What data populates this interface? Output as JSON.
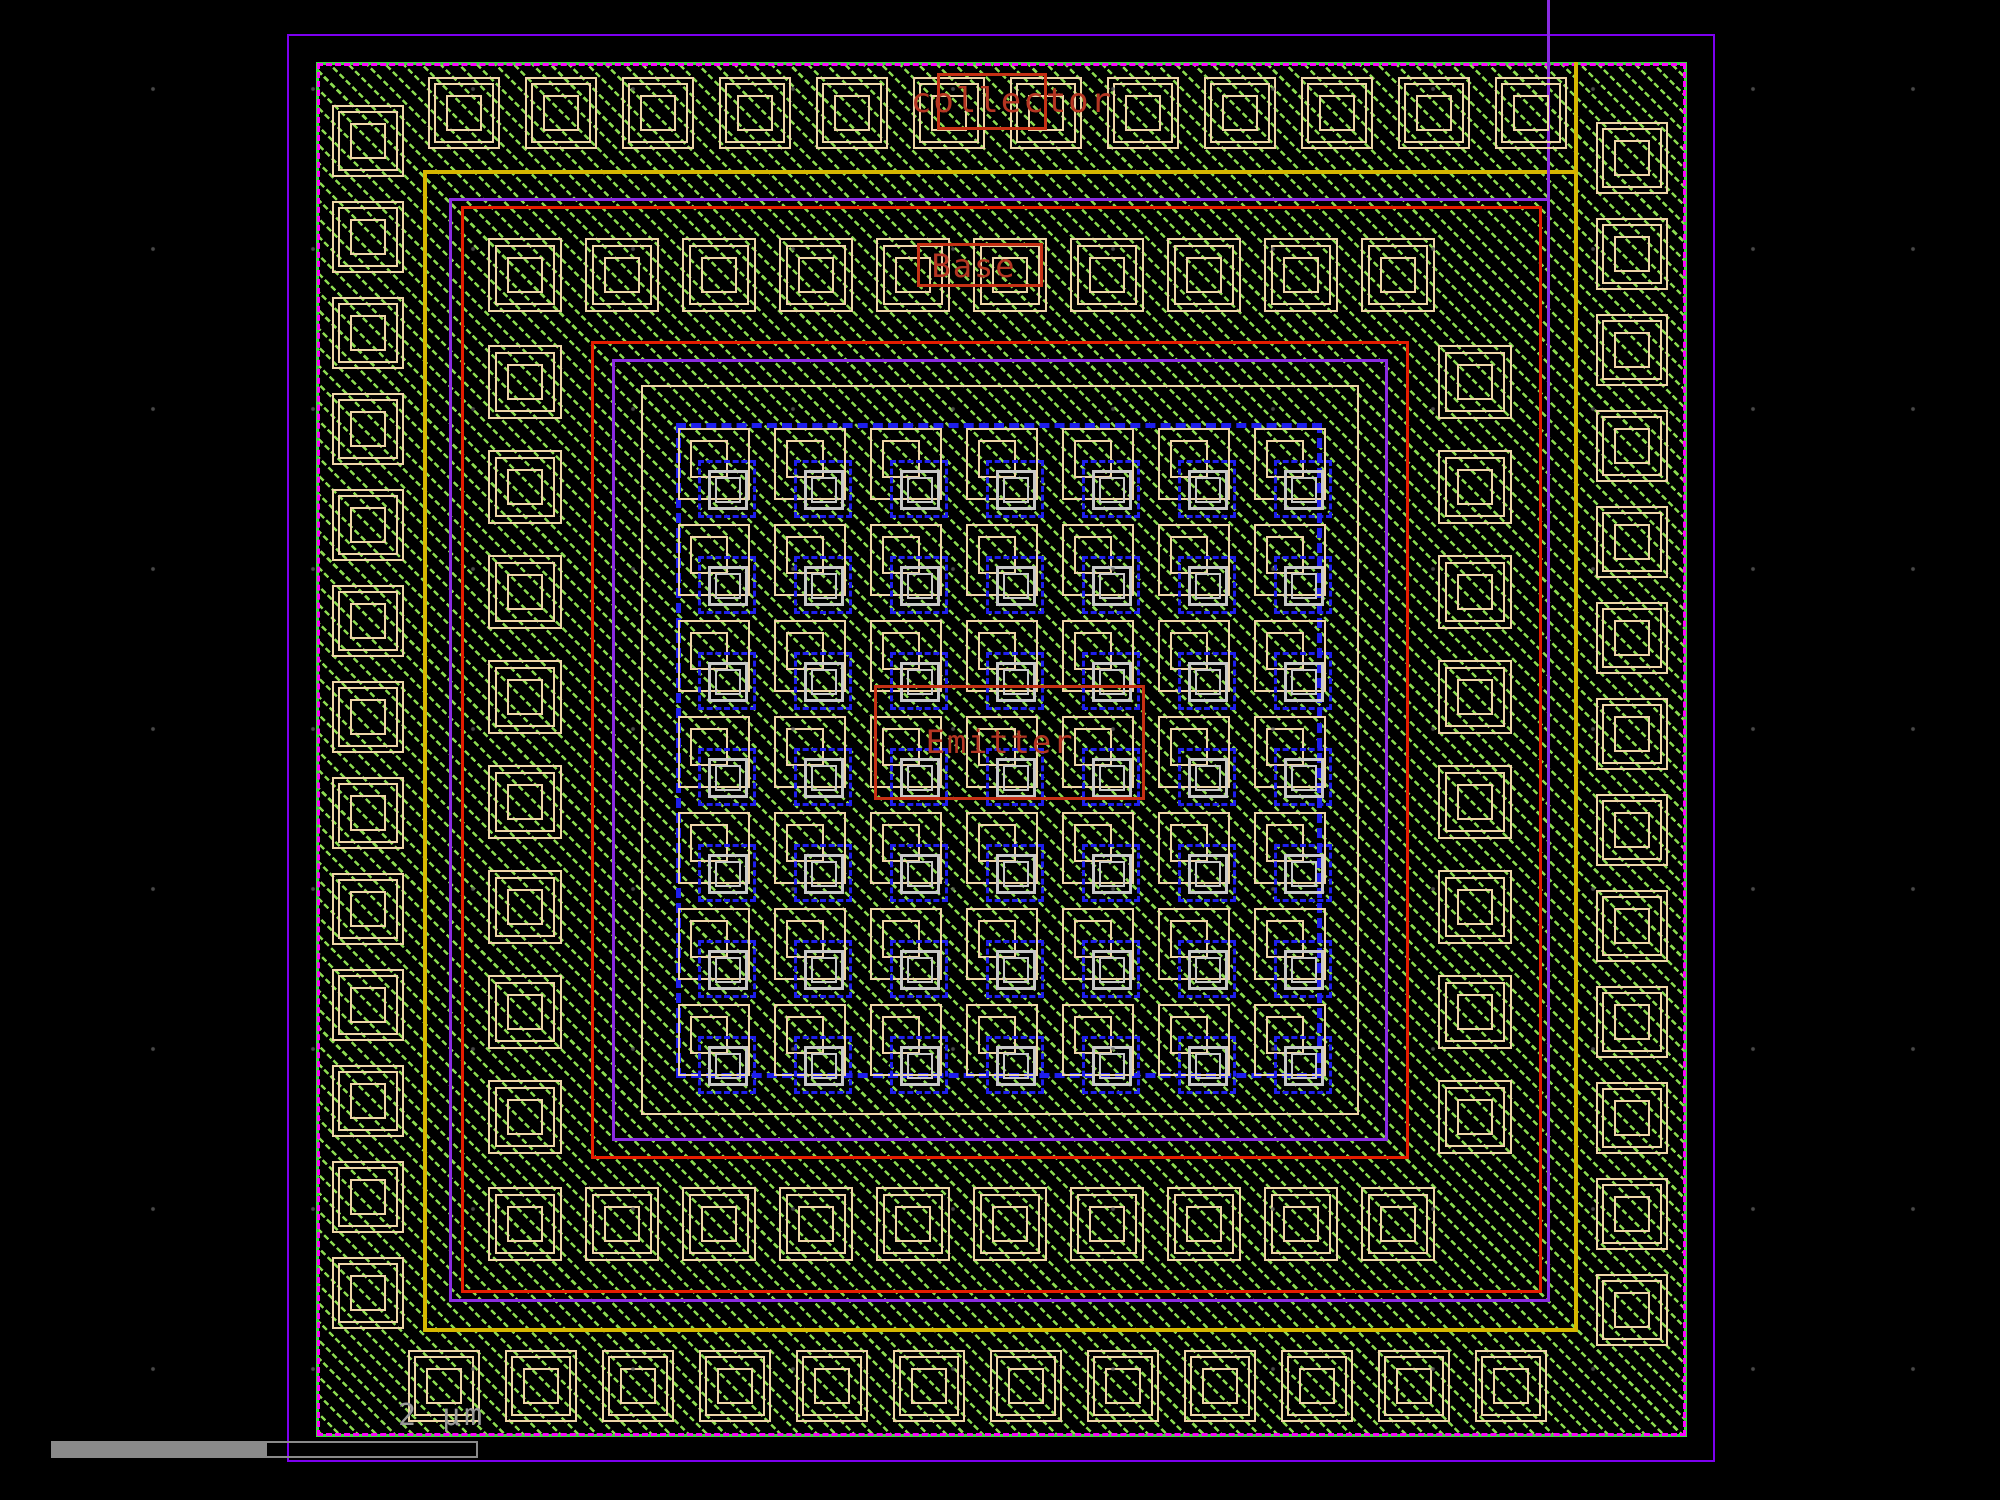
{
  "labels": {
    "collector": "collector",
    "base": "Base",
    "emitter": "Emitter"
  },
  "scale_bar": {
    "label": "2 µm"
  },
  "palette": {
    "bg": "#000000",
    "dot": "#5a5a5a",
    "die_purple": "#7d00f0",
    "hatch_green": "#8cdc50",
    "border_green": "#3ddd3d",
    "implant_magenta": "#ff00ff",
    "metal_yellow": "#d6b600",
    "ring_purple": "#8a2be2",
    "ring_red": "#e51c00",
    "pad_tan": "#efd5a8",
    "emitter_blue": "#1e1eee",
    "poly_gray": "#c8c8c8",
    "label_red": "#b43522",
    "label_box_red": "#c53014",
    "bar_gray": "#8a8a8a",
    "text_gray": "#9a9a9a"
  },
  "structure": {
    "rings": [
      {
        "name": "die-boundary",
        "x": 287,
        "y": 34,
        "w": 1428,
        "h": 1428,
        "color": "die_purple",
        "bw": 2,
        "style": "solid"
      },
      {
        "name": "metal-ring-yellow",
        "x": 423,
        "y": 170,
        "w": 1155,
        "h": 1162,
        "color": "metal_yellow",
        "bw": 4,
        "style": "solid"
      },
      {
        "name": "well-ring-purple-outer",
        "x": 449,
        "y": 198,
        "w": 1101,
        "h": 1104,
        "color": "ring_purple",
        "bw": 3,
        "style": "solid"
      },
      {
        "name": "ring-red-outer",
        "x": 461,
        "y": 206,
        "w": 1081,
        "h": 1087,
        "color": "ring_red",
        "bw": 3,
        "style": "solid"
      },
      {
        "name": "ring-red-inner",
        "x": 591,
        "y": 341,
        "w": 818,
        "h": 818,
        "color": "ring_red",
        "bw": 3,
        "style": "solid"
      },
      {
        "name": "well-ring-purple-inner",
        "x": 612,
        "y": 359,
        "w": 776,
        "h": 782,
        "color": "ring_purple",
        "bw": 3,
        "style": "solid"
      },
      {
        "name": "ring-tan",
        "x": 641,
        "y": 385,
        "w": 718,
        "h": 730,
        "color": "pad_tan",
        "bw": 2,
        "style": "solid"
      },
      {
        "name": "emitter-window-blue",
        "x": 676,
        "y": 423,
        "w": 646,
        "h": 655,
        "color": "emitter_blue",
        "bw": 5,
        "style": "dashed"
      }
    ],
    "lines": [
      {
        "name": "purple-stub-line",
        "x": 1547,
        "y": 0,
        "w": 3,
        "h": 198,
        "color": "ring_purple"
      },
      {
        "name": "yellow-stub-line",
        "x": 1574,
        "y": 62,
        "w": 4,
        "h": 108,
        "color": "metal_yellow"
      }
    ],
    "contact_rings": [
      {
        "name": "collector-contact",
        "size": 72,
        "nest": [
          [
            0,
            72
          ],
          [
            6,
            60
          ],
          [
            18,
            36
          ]
        ],
        "runs": [
          {
            "dir": "h",
            "x": 428,
            "y": 77,
            "count": 12,
            "pitch": 97
          },
          {
            "dir": "h",
            "x": 408,
            "y": 1350,
            "count": 12,
            "pitch": 97
          },
          {
            "dir": "v",
            "x": 332,
            "y": 105,
            "count": 13,
            "pitch": 96
          },
          {
            "dir": "v",
            "x": 1596,
            "y": 122,
            "count": 13,
            "pitch": 96
          }
        ]
      },
      {
        "name": "base-contact",
        "size": 74,
        "nest": [
          [
            0,
            74
          ],
          [
            7,
            60
          ],
          [
            19,
            36
          ]
        ],
        "runs": [
          {
            "dir": "h",
            "x": 488,
            "y": 238,
            "count": 10,
            "pitch": 97
          },
          {
            "dir": "h",
            "x": 488,
            "y": 1187,
            "count": 10,
            "pitch": 97
          },
          {
            "dir": "v",
            "x": 488,
            "y": 345,
            "count": 8,
            "pitch": 105
          },
          {
            "dir": "v",
            "x": 1438,
            "y": 345,
            "count": 8,
            "pitch": 105
          }
        ]
      }
    ],
    "emitter_array": {
      "x": 678,
      "y": 428,
      "cols": 7,
      "rows": 7,
      "pitch": 96,
      "parts": [
        {
          "dx": 0,
          "dy": 0,
          "s": 72,
          "color": "pad_tan",
          "bw": 2,
          "style": "solid"
        },
        {
          "dx": 12,
          "dy": 12,
          "s": 38,
          "color": "pad_tan",
          "bw": 2,
          "style": "solid"
        },
        {
          "dx": 20,
          "dy": 32,
          "s": 58,
          "color": "emitter_blue",
          "bw": 3,
          "style": "dashed"
        },
        {
          "dx": 30,
          "dy": 42,
          "s": 40,
          "color": "poly_gray",
          "bw": 3,
          "style": "solid"
        },
        {
          "dx": 37,
          "dy": 49,
          "s": 26,
          "color": "poly_gray",
          "bw": 2,
          "style": "solid"
        }
      ]
    },
    "label_boxes": [
      {
        "name": "collector-label-box",
        "x": 937,
        "y": 73,
        "w": 110,
        "h": 57
      },
      {
        "name": "base-label-box",
        "x": 917,
        "y": 243,
        "w": 126,
        "h": 44
      },
      {
        "name": "emitter-label-box",
        "x": 874,
        "y": 685,
        "w": 271,
        "h": 115
      }
    ],
    "label_pos": {
      "collector": {
        "x": 1012,
        "y": 101,
        "fs": 34
      },
      "base": {
        "x": 974,
        "y": 266,
        "fs": 32
      },
      "emitter": {
        "x": 1000,
        "y": 742,
        "fs": 32
      }
    },
    "scale_bar_geom": {
      "fill": {
        "x": 51,
        "y": 1441,
        "w": 214,
        "h": 17
      },
      "outline": {
        "x": 265,
        "y": 1441,
        "w": 213,
        "h": 17
      },
      "label": {
        "x": 398,
        "y": 1398
      }
    }
  }
}
